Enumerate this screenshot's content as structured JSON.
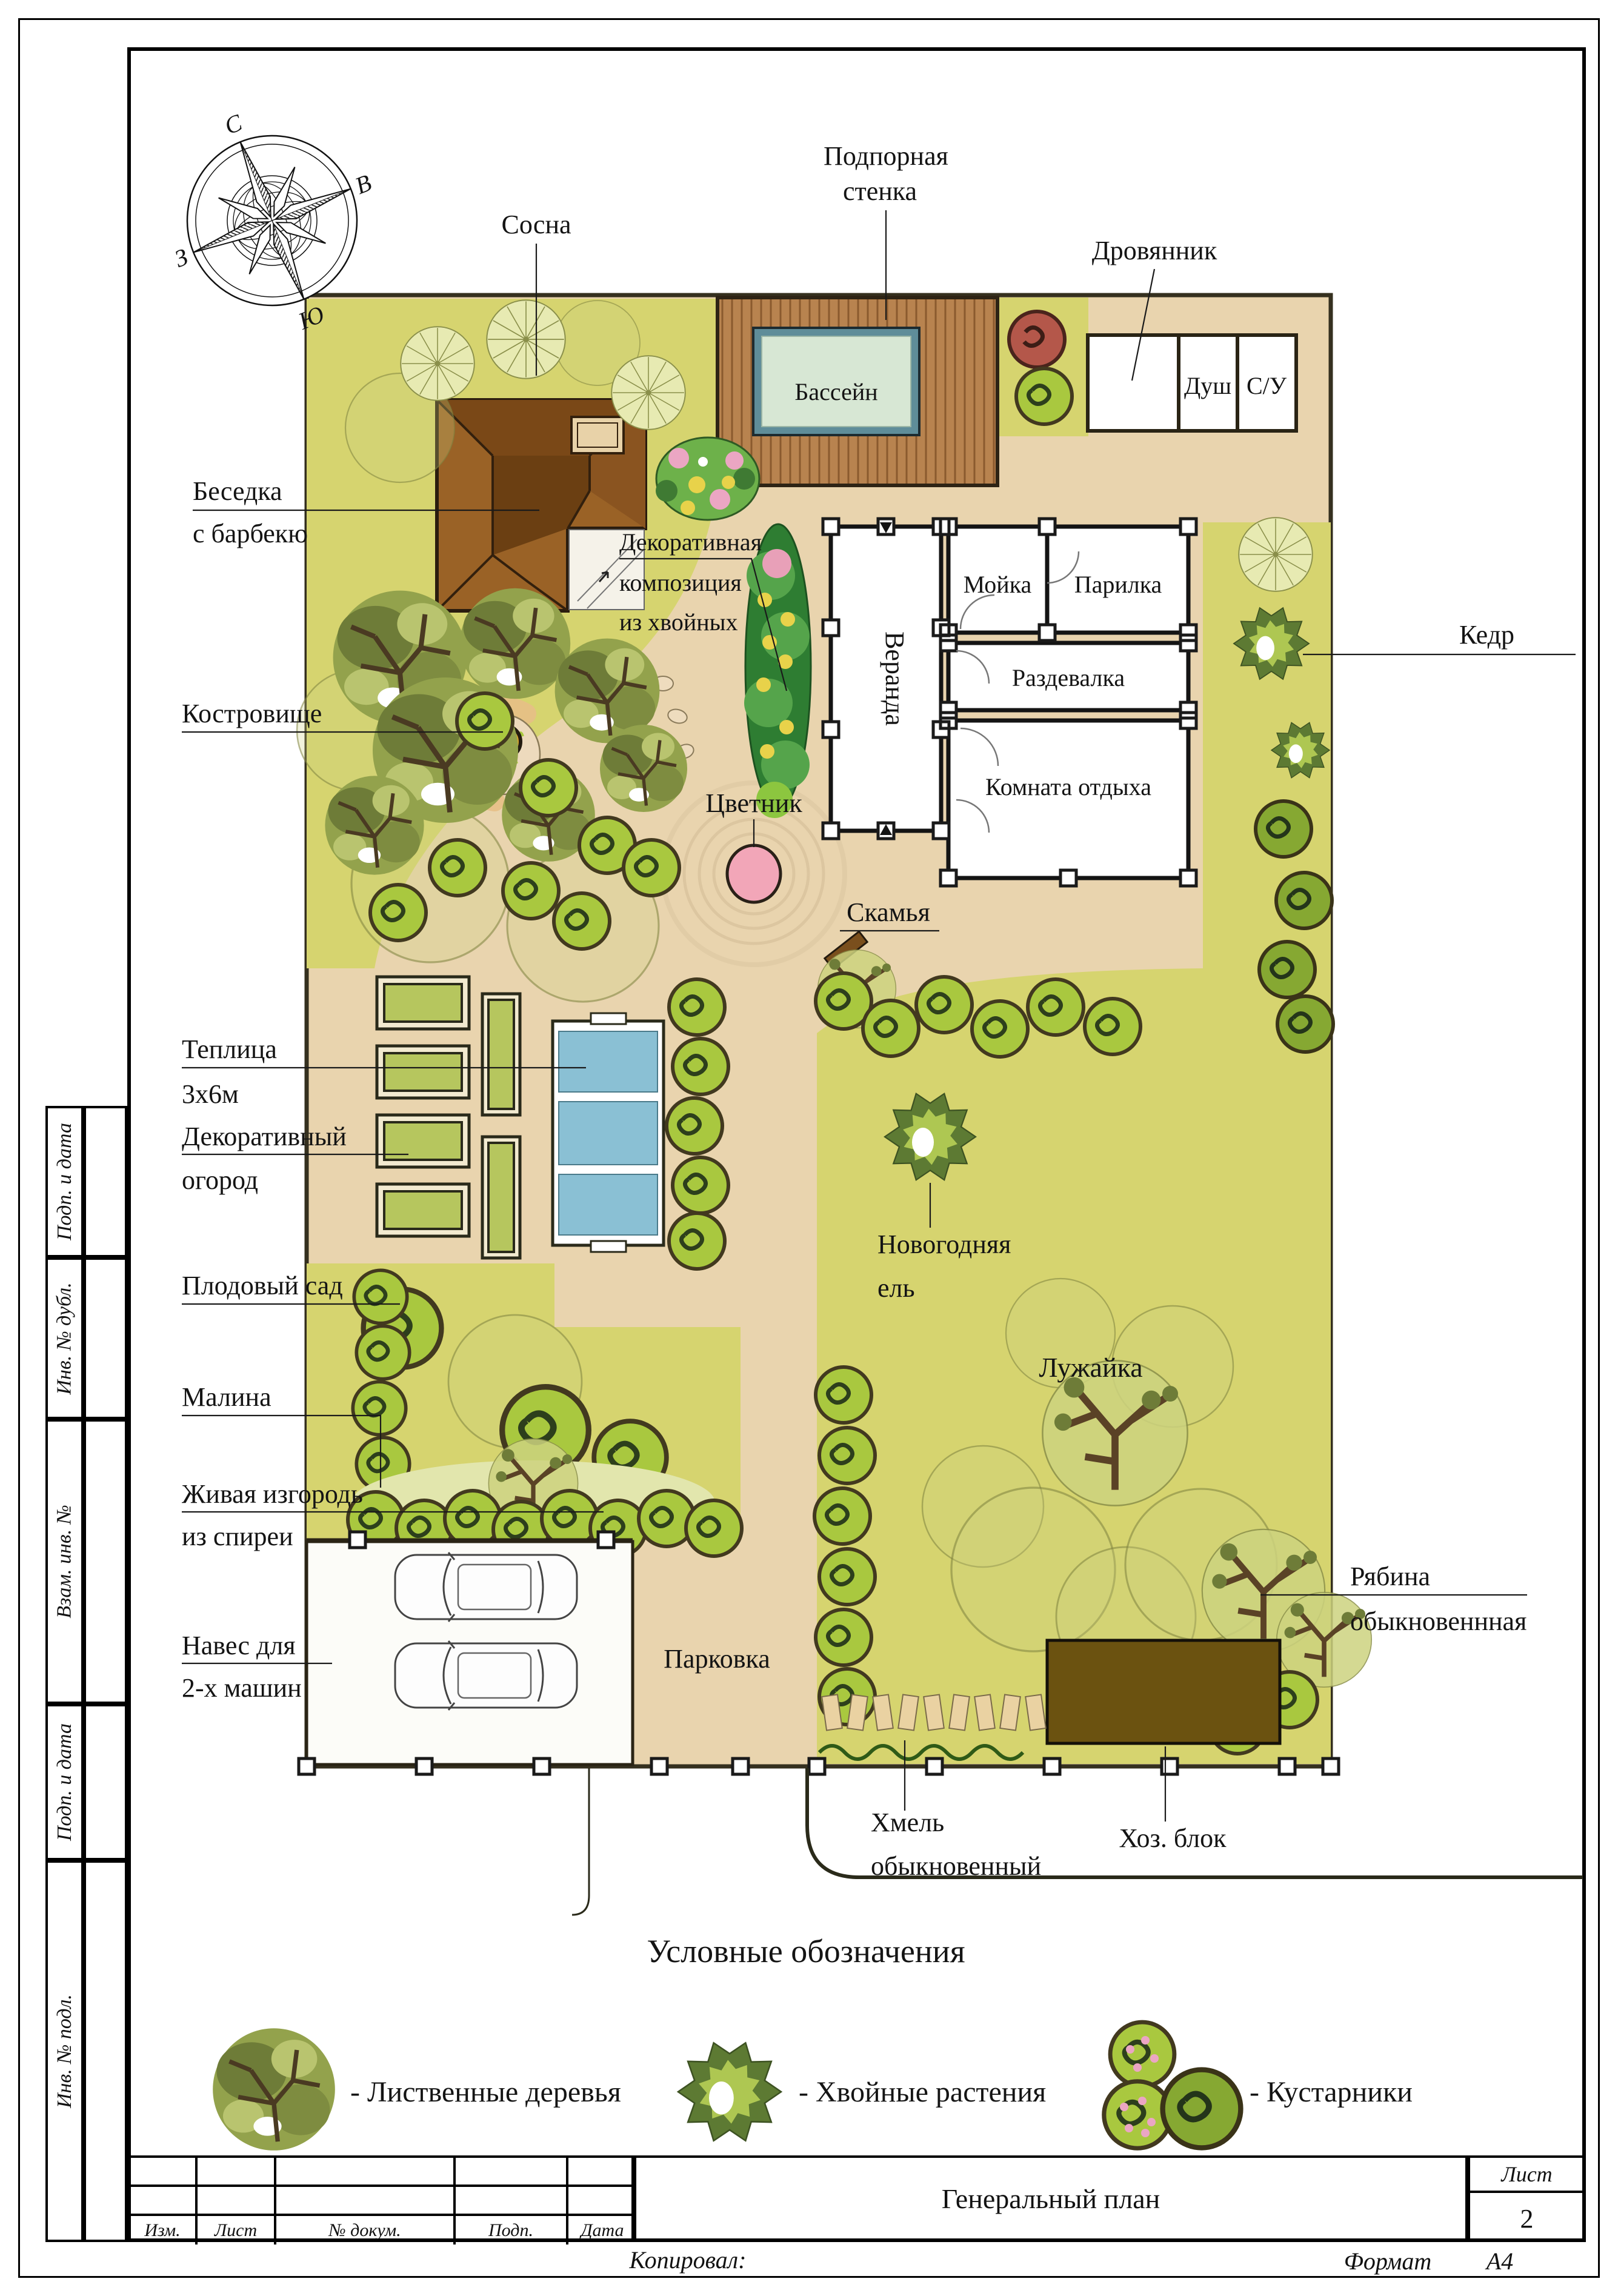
{
  "compass": {
    "n": "С",
    "e": "В",
    "s": "Ю",
    "w": "З"
  },
  "plan": {
    "sosna": "Сосна",
    "podpornaya_1": "Подпорная",
    "podpornaya_2": "стенка",
    "drovyannik": "Дровянник",
    "bassein": "Бассейн",
    "dush": "Душ",
    "su": "С/У",
    "besedka_1": "Беседка",
    "besedka_2": "с барбекю",
    "dekor_1": "Декоративная",
    "dekor_2": "композиция",
    "dekor_3": "из хвойных",
    "veranda": "Веранда",
    "moika": "Мойка",
    "parilka": "Парилка",
    "razdevalka": "Раздевалка",
    "komnata": "Комната отдыха",
    "kedr": "Кедр",
    "kostrovishche": "Костровище",
    "tsvetnik": "Цветник",
    "skamya": "Скамья",
    "teplitsa_1": "Теплица",
    "teplitsa_2": "3х6м",
    "ogorod_1": "Декоративный",
    "ogorod_2": "огород",
    "sad": "Плодовый сад",
    "malina": "Малина",
    "novogodnyaya_1": "Новогодняя",
    "novogodnyaya_2": "ель",
    "luzhaika": "Лужайка",
    "izgorod_1": "Живая изгородь",
    "izgorod_2": "из спиреи",
    "naves_1": "Навес для",
    "naves_2": "2-х машин",
    "parkovka": "Парковка",
    "ryabina_1": "Рябина",
    "ryabina_2": "обыкновеннная",
    "khmel_1": "Хмель",
    "khmel_2": "обыкновенный",
    "khozblok": "Хоз. блок"
  },
  "legend": {
    "title": "Условные обозначения",
    "items": [
      {
        "label": "- Лиственные деревья"
      },
      {
        "label": "- Хвойные растения"
      },
      {
        "label": "- Кустарники"
      }
    ]
  },
  "stamp": {
    "izm": "Изм.",
    "list": "Лист",
    "ndok": "№ докум.",
    "podp": "Подп.",
    "data": "Дата",
    "title": "Генеральный план",
    "sheet_label": "Лист",
    "sheet_number": "2",
    "kopiroval": "Копировал:",
    "format_label": "Формат",
    "format_value": "А4"
  },
  "sidebar": {
    "items": [
      "Подп. и дата",
      "Инв. № дубл.",
      "Взам. инв. №",
      "Подп. и дата",
      "Инв. № подл."
    ]
  },
  "colors": {
    "lawn": "#d6d46f",
    "paving": "#e9d4ae",
    "deck": "#b8834f",
    "roof": "#9a6226",
    "pool_frame": "#5f8d99",
    "pool_water": "#d7e7d4",
    "flowerbed_pink": "#f2a6b8",
    "shed": "#6b5210",
    "shrub": "#a9c83f",
    "conifer": "#5d7a33"
  }
}
